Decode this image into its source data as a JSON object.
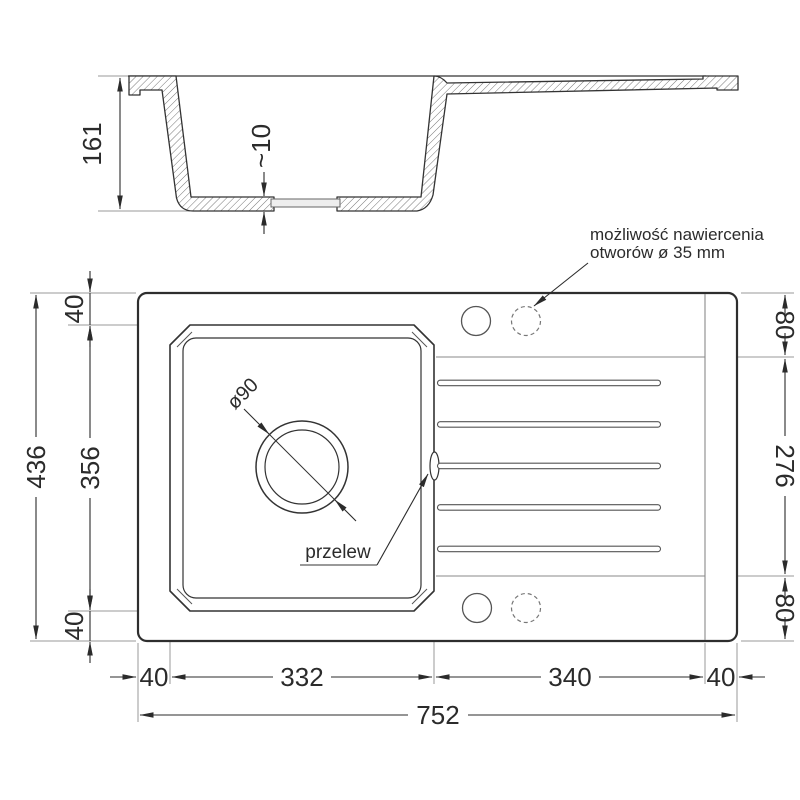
{
  "section": {
    "depth_label": "161",
    "drain_depth_label": "~10"
  },
  "plan": {
    "left": {
      "height_total": "436",
      "top_margin": "40",
      "bowl_height": "356",
      "bottom_margin": "40"
    },
    "right": {
      "top_band": "80",
      "drainer_height": "276",
      "bottom_band": "80"
    },
    "bottom": {
      "left_margin": "40",
      "bowl_width": "332",
      "drainer_width": "340",
      "right_margin": "40",
      "total": "752"
    },
    "drain_label": "ø90",
    "overflow_label": "przelew",
    "holes_note_line1": "możliwość nawiercenia",
    "holes_note_line2": "otworów ø 35 mm"
  },
  "colors": {
    "line": "#333333",
    "dim": "#2b2b2b",
    "aux": "#9a9a9a",
    "hatch": "#777777"
  }
}
